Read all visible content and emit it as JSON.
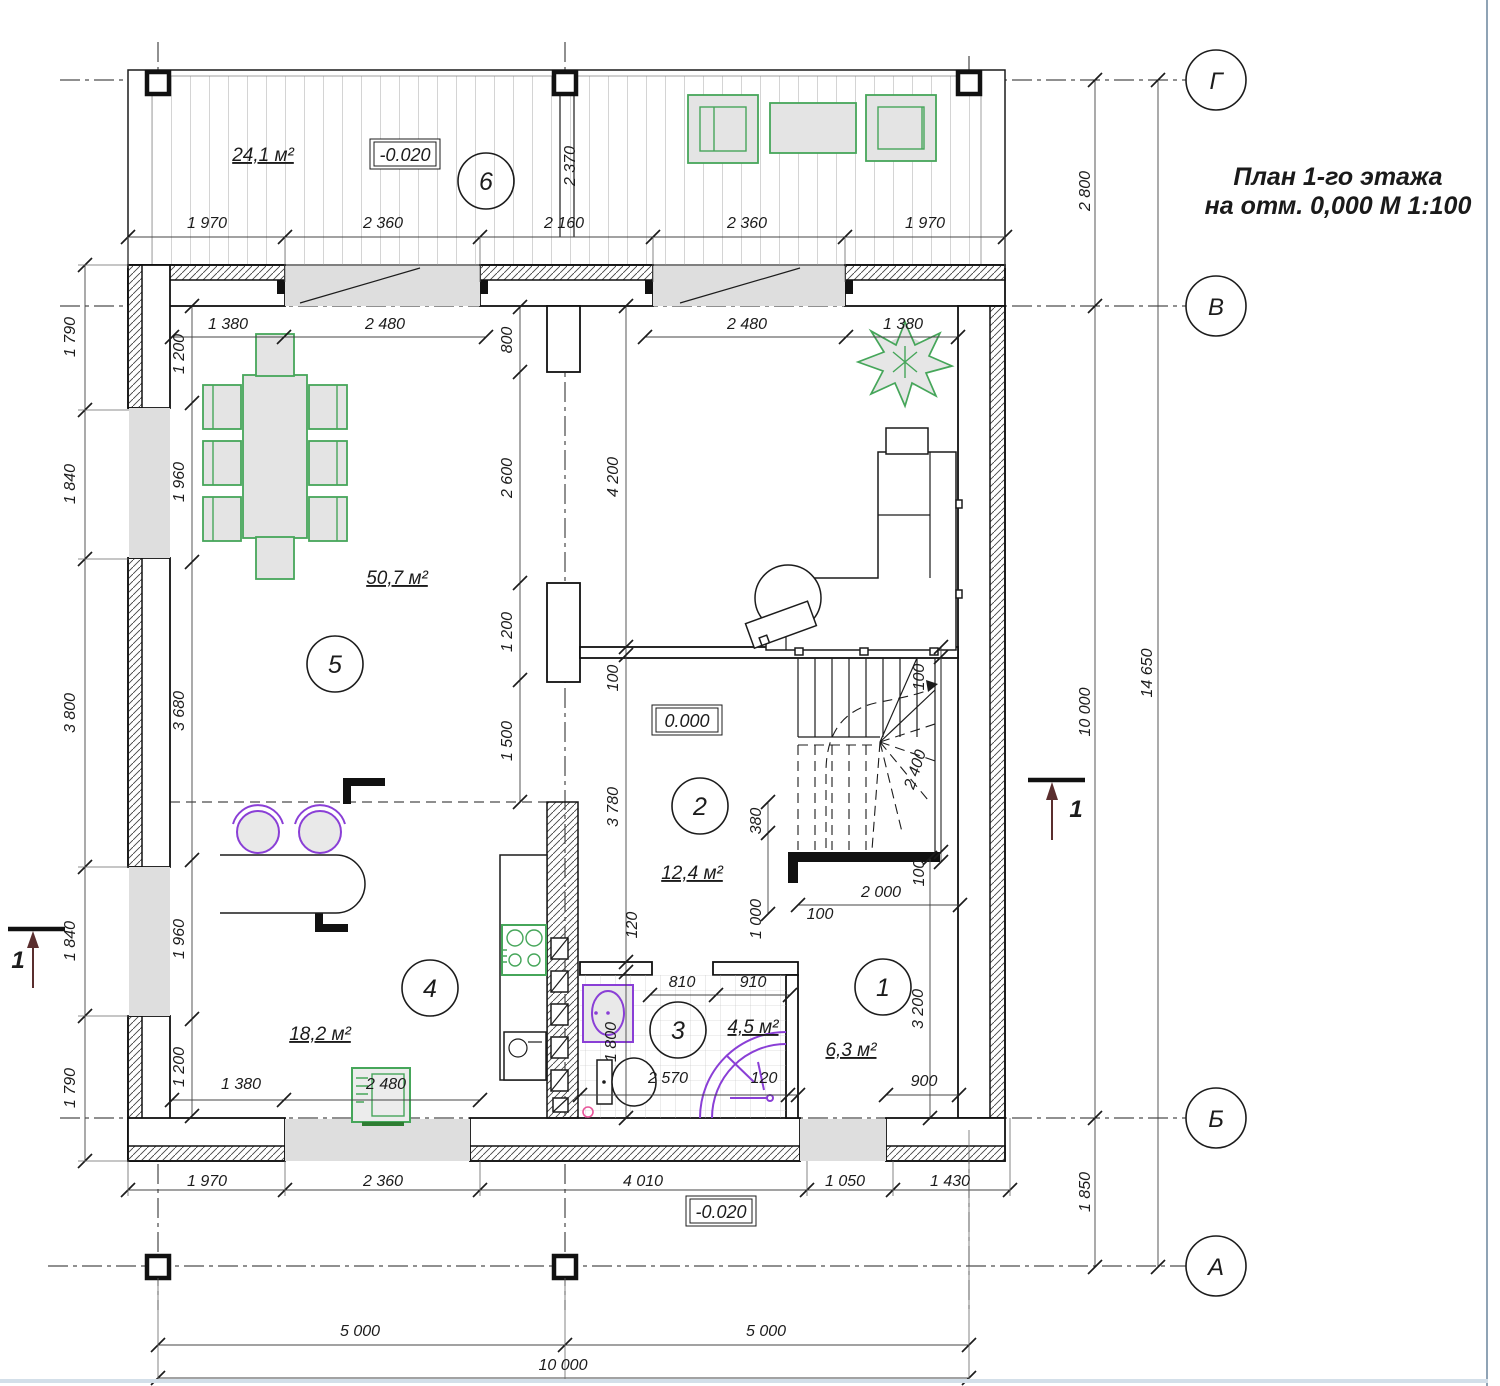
{
  "title": {
    "line1": "План 1-го этажа",
    "line2": "на отм. 0,000  М 1:100"
  },
  "axes": {
    "circle_x": 1216,
    "radius": 30,
    "horizontal": [
      {
        "label": "Г",
        "y": 80
      },
      {
        "label": "В",
        "y": 306
      },
      {
        "label": "Б",
        "y": 1118
      },
      {
        "label": "А",
        "y": 1266
      }
    ]
  },
  "rooms": [
    {
      "number": "6",
      "area": "24,1 м²",
      "cx": 486,
      "cy": 181,
      "ax": 263,
      "ay": 161
    },
    {
      "number": "5",
      "area": "50,7 м²",
      "cx": 335,
      "cy": 664,
      "ax": 397,
      "ay": 584
    },
    {
      "number": "4",
      "area": "18,2 м²",
      "cx": 430,
      "cy": 988,
      "ax": 320,
      "ay": 1040
    },
    {
      "number": "2",
      "area": "12,4 м²",
      "cx": 700,
      "cy": 806,
      "ax": 692,
      "ay": 879
    },
    {
      "number": "3",
      "area": "4,5 м²",
      "cx": 678,
      "cy": 1030,
      "ax": 753,
      "ay": 1033
    },
    {
      "number": "1",
      "area": "6,3 м²",
      "cx": 883,
      "cy": 987,
      "ax": 851,
      "ay": 1056
    }
  ],
  "elevations": [
    {
      "text": "-0.020",
      "x": 405,
      "y": 155
    },
    {
      "text": "0.000",
      "x": 687,
      "y": 721
    },
    {
      "text": "-0.020",
      "x": 721,
      "y": 1212
    }
  ],
  "section_marks": [
    {
      "label": "1",
      "x": 1076,
      "y": 817
    },
    {
      "label": "1",
      "x": 18,
      "y": 968
    }
  ],
  "dimensions": [
    {
      "t": "1 970",
      "x": 207,
      "y": 228
    },
    {
      "t": "2 360",
      "x": 383,
      "y": 228
    },
    {
      "t": "2 160",
      "x": 564,
      "y": 228
    },
    {
      "t": "2 360",
      "x": 747,
      "y": 228
    },
    {
      "t": "1 970",
      "x": 925,
      "y": 228
    },
    {
      "t": "1 380",
      "x": 228,
      "y": 329
    },
    {
      "t": "2 480",
      "x": 385,
      "y": 329
    },
    {
      "t": "2 480",
      "x": 747,
      "y": 329
    },
    {
      "t": "1 380",
      "x": 903,
      "y": 329
    },
    {
      "t": "810",
      "x": 682,
      "y": 987
    },
    {
      "t": "910",
      "x": 753,
      "y": 987
    },
    {
      "t": "2 570",
      "x": 668,
      "y": 1083
    },
    {
      "t": "120",
      "x": 764,
      "y": 1083
    },
    {
      "t": "900",
      "x": 924,
      "y": 1086
    },
    {
      "t": "2 000",
      "x": 881,
      "y": 897
    },
    {
      "t": "100",
      "x": 820,
      "y": 919
    },
    {
      "t": "1 380",
      "x": 241,
      "y": 1089
    },
    {
      "t": "2 480",
      "x": 386,
      "y": 1089
    },
    {
      "t": "1 970",
      "x": 207,
      "y": 1186
    },
    {
      "t": "2 360",
      "x": 383,
      "y": 1186
    },
    {
      "t": "4 010",
      "x": 643,
      "y": 1186
    },
    {
      "t": "1 050",
      "x": 845,
      "y": 1186
    },
    {
      "t": "1 430",
      "x": 950,
      "y": 1186
    },
    {
      "t": "5 000",
      "x": 360,
      "y": 1336
    },
    {
      "t": "5 000",
      "x": 766,
      "y": 1336
    },
    {
      "t": "10 000",
      "x": 563,
      "y": 1370
    },
    {
      "t": "2 370",
      "x": 575,
      "y": 166,
      "r": -90
    },
    {
      "t": "2 800",
      "x": 1090,
      "y": 191,
      "r": -90
    },
    {
      "t": "10 000",
      "x": 1090,
      "y": 712,
      "r": -90
    },
    {
      "t": "1 850",
      "x": 1090,
      "y": 1192,
      "r": -90
    },
    {
      "t": "14 650",
      "x": 1152,
      "y": 673,
      "r": -90
    },
    {
      "t": "1 790",
      "x": 75,
      "y": 337,
      "r": -90
    },
    {
      "t": "1 840",
      "x": 75,
      "y": 484,
      "r": -90
    },
    {
      "t": "3 800",
      "x": 75,
      "y": 713,
      "r": -90
    },
    {
      "t": "1 840",
      "x": 75,
      "y": 941,
      "r": -90
    },
    {
      "t": "1 790",
      "x": 75,
      "y": 1088,
      "r": -90
    },
    {
      "t": "1 200",
      "x": 184,
      "y": 354,
      "r": -90
    },
    {
      "t": "1 960",
      "x": 184,
      "y": 482,
      "r": -90
    },
    {
      "t": "3 680",
      "x": 184,
      "y": 711,
      "r": -90
    },
    {
      "t": "1 960",
      "x": 184,
      "y": 939,
      "r": -90
    },
    {
      "t": "1 200",
      "x": 184,
      "y": 1067,
      "r": -90
    },
    {
      "t": "800",
      "x": 512,
      "y": 340,
      "r": -90
    },
    {
      "t": "2 600",
      "x": 512,
      "y": 478,
      "r": -90
    },
    {
      "t": "1 200",
      "x": 512,
      "y": 632,
      "r": -90
    },
    {
      "t": "1 500",
      "x": 512,
      "y": 741,
      "r": -90
    },
    {
      "t": "4 200",
      "x": 618,
      "y": 477,
      "r": -90
    },
    {
      "t": "100",
      "x": 618,
      "y": 678,
      "r": -90
    },
    {
      "t": "3 780",
      "x": 618,
      "y": 807,
      "r": -90
    },
    {
      "t": "120",
      "x": 637,
      "y": 925,
      "r": -90
    },
    {
      "t": "100",
      "x": 924,
      "y": 677,
      "r": -90
    },
    {
      "t": "2 400",
      "x": 920,
      "y": 771,
      "r": -72
    },
    {
      "t": "100",
      "x": 924,
      "y": 873,
      "r": -90
    },
    {
      "t": "380",
      "x": 761,
      "y": 821,
      "r": -90
    },
    {
      "t": "1 000",
      "x": 761,
      "y": 919,
      "r": -90
    },
    {
      "t": "1 800",
      "x": 616,
      "y": 1042,
      "r": -90
    },
    {
      "t": "3 200",
      "x": 923,
      "y": 1009,
      "r": -90
    }
  ],
  "colors": {
    "line": "#1c1c1c",
    "green": "#46a65a",
    "purple": "#8a3fd6",
    "pink": "#e8559a",
    "gray_fill": "#dedede",
    "section_arrow": "#5a2e2e"
  }
}
